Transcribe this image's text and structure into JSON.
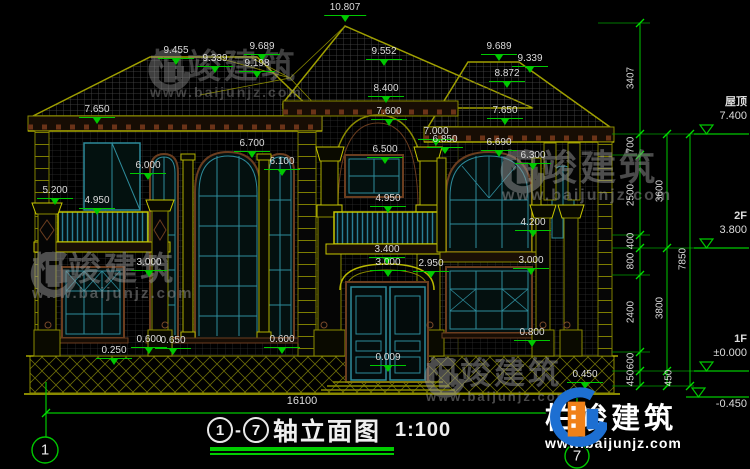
{
  "canvas": {
    "width": 750,
    "height": 469,
    "background": "#000000"
  },
  "colors": {
    "dimension_green": "#00C800",
    "text": "#DCDCDC",
    "cad_yellow": "#8A8A00",
    "cad_teal": "#2E8B9B",
    "cad_brown": "#6B3D1F",
    "watermark_gray": "#969696",
    "brand_blue": "#1D6FD2",
    "brand_orange": "#F08119"
  },
  "brand": {
    "name": "柏竣建筑",
    "url": "www.baijunjz.com"
  },
  "title_block": {
    "axis_start": "1",
    "separator": "-",
    "axis_end": "7",
    "title": "轴立面图",
    "scale": "1:100"
  },
  "axis_bubbles": [
    {
      "n": "1"
    },
    {
      "n": "7"
    }
  ],
  "dimensions": {
    "total_width": "16100",
    "annotations": [
      {
        "t": "10.807",
        "x": 345,
        "y": 3
      },
      {
        "t": "9.455",
        "x": 176,
        "y": 46
      },
      {
        "t": "9.339",
        "x": 215,
        "y": 54
      },
      {
        "t": "9.689",
        "x": 262,
        "y": 42
      },
      {
        "t": "9.198",
        "x": 257,
        "y": 59
      },
      {
        "t": "9.552",
        "x": 384,
        "y": 47
      },
      {
        "t": "9.689",
        "x": 499,
        "y": 42
      },
      {
        "t": "9.339",
        "x": 530,
        "y": 54
      },
      {
        "t": "8.872",
        "x": 507,
        "y": 69
      },
      {
        "t": "8.400",
        "x": 386,
        "y": 84
      },
      {
        "t": "7.650",
        "x": 97,
        "y": 105
      },
      {
        "t": "7.600",
        "x": 389,
        "y": 107
      },
      {
        "t": "7.650",
        "x": 505,
        "y": 106
      },
      {
        "t": "7.000",
        "x": 436,
        "y": 127
      },
      {
        "t": "6.850",
        "x": 445,
        "y": 135
      },
      {
        "t": "6.700",
        "x": 252,
        "y": 139
      },
      {
        "t": "6.500",
        "x": 385,
        "y": 145
      },
      {
        "t": "6.100",
        "x": 282,
        "y": 157
      },
      {
        "t": "6.000",
        "x": 148,
        "y": 161
      },
      {
        "t": "6.690",
        "x": 499,
        "y": 138
      },
      {
        "t": "6.300",
        "x": 533,
        "y": 151
      },
      {
        "t": "5.200",
        "x": 55,
        "y": 186
      },
      {
        "t": "4.950",
        "x": 97,
        "y": 196
      },
      {
        "t": "4.950",
        "x": 388,
        "y": 194
      },
      {
        "t": "4.200",
        "x": 533,
        "y": 218
      },
      {
        "t": "3.400",
        "x": 387,
        "y": 245
      },
      {
        "t": "3.000",
        "x": 388,
        "y": 258
      },
      {
        "t": "2.950",
        "x": 431,
        "y": 259
      },
      {
        "t": "3.000",
        "x": 149,
        "y": 258
      },
      {
        "t": "3.000",
        "x": 531,
        "y": 256
      },
      {
        "t": "0.800",
        "x": 532,
        "y": 328
      },
      {
        "t": "0.600",
        "x": 149,
        "y": 335
      },
      {
        "t": "0.650",
        "x": 173,
        "y": 336
      },
      {
        "t": "0.250",
        "x": 114,
        "y": 346
      },
      {
        "t": "0.600",
        "x": 282,
        "y": 335
      },
      {
        "t": "0.009",
        "x": 388,
        "y": 353
      },
      {
        "t": "0.450",
        "x": 585,
        "y": 370
      }
    ],
    "vertical_dims": [
      {
        "t": "3407",
        "x": 631,
        "y": 78
      },
      {
        "t": "700",
        "x": 631,
        "y": 145
      },
      {
        "t": "2500",
        "x": 631,
        "y": 195
      },
      {
        "t": "400",
        "x": 631,
        "y": 241
      },
      {
        "t": "800",
        "x": 631,
        "y": 261
      },
      {
        "t": "2400",
        "x": 631,
        "y": 312
      },
      {
        "t": "600",
        "x": 631,
        "y": 361
      },
      {
        "t": "450",
        "x": 631,
        "y": 378
      },
      {
        "t": "3600",
        "x": 660,
        "y": 191
      },
      {
        "t": "3800",
        "x": 660,
        "y": 308
      },
      {
        "t": "450",
        "x": 669,
        "y": 378
      },
      {
        "t": "7850",
        "x": 683,
        "y": 259
      }
    ],
    "levels": [
      {
        "label": "屋顶",
        "value": "7.400",
        "y": 134,
        "below": false
      },
      {
        "label": "2F",
        "value": "3.800",
        "y": 248,
        "below": false
      },
      {
        "label": "1F",
        "value": "±0.000",
        "y": 371,
        "below": false
      },
      {
        "label": "",
        "value": "-0.450",
        "y": 397,
        "below": true
      }
    ]
  },
  "watermarks": [
    {
      "x": 146,
      "y": 50,
      "icon": 44,
      "name_size": 34,
      "url_size": 14,
      "opacity": 0.42
    },
    {
      "x": 28,
      "y": 252,
      "icon": 48,
      "name_size": 33,
      "url_size": 15,
      "opacity": 0.5
    },
    {
      "x": 498,
      "y": 150,
      "icon": 46,
      "name_size": 36,
      "url_size": 16,
      "opacity": 0.5
    },
    {
      "x": 422,
      "y": 358,
      "icon": 42,
      "name_size": 31,
      "url_size": 13,
      "opacity": 0.5
    }
  ]
}
